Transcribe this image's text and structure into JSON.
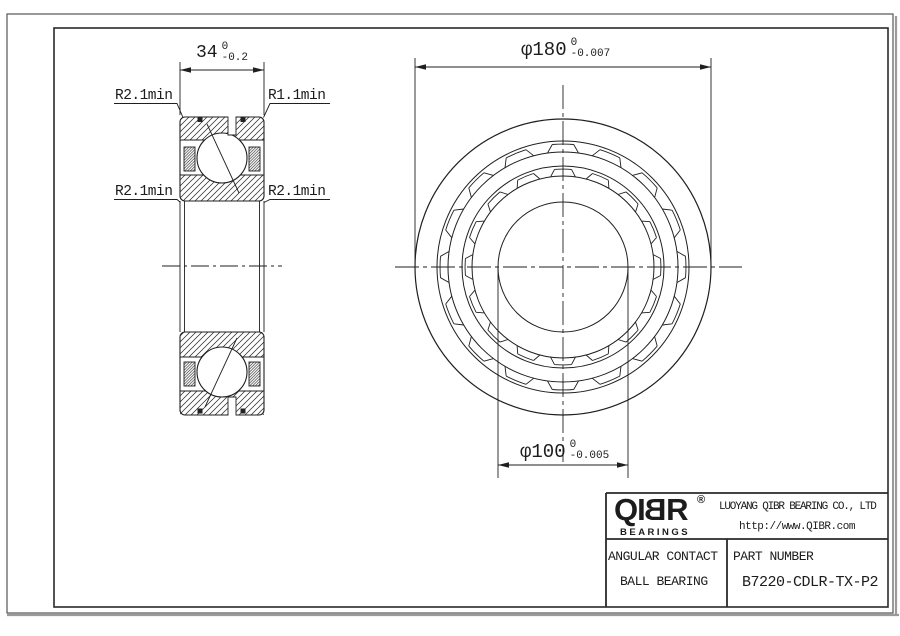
{
  "dimensions": {
    "width": {
      "value": "34",
      "tol_upper": "0",
      "tol_lower": "-0.2"
    },
    "outer_diameter": {
      "value": "φ180",
      "tol_upper": "0",
      "tol_lower": "-0.007"
    },
    "bore": {
      "value": "φ100",
      "tol_upper": "0",
      "tol_lower": "-0.005"
    }
  },
  "radius_labels": {
    "top_left": "R2.1min",
    "top_right": "R1.1min",
    "mid_left": "R2.1min",
    "mid_right": "R2.1min"
  },
  "title_block": {
    "logo": {
      "prefix": "QI",
      "mirrored_letter": "B",
      "suffix": "R",
      "registered_mark": "®",
      "subtitle": "BEARINGS"
    },
    "company": "LUOYANG QIBR BEARING CO., LTD",
    "website": "http://www.QIBR.com",
    "product_line1": "ANGULAR CONTACT",
    "product_line2": "BALL BEARING",
    "part_number_label": "PART NUMBER",
    "part_number": "B7220-CDLR-TX-P2"
  },
  "colors": {
    "line": "#1f1f1f",
    "background": "#ffffff"
  }
}
